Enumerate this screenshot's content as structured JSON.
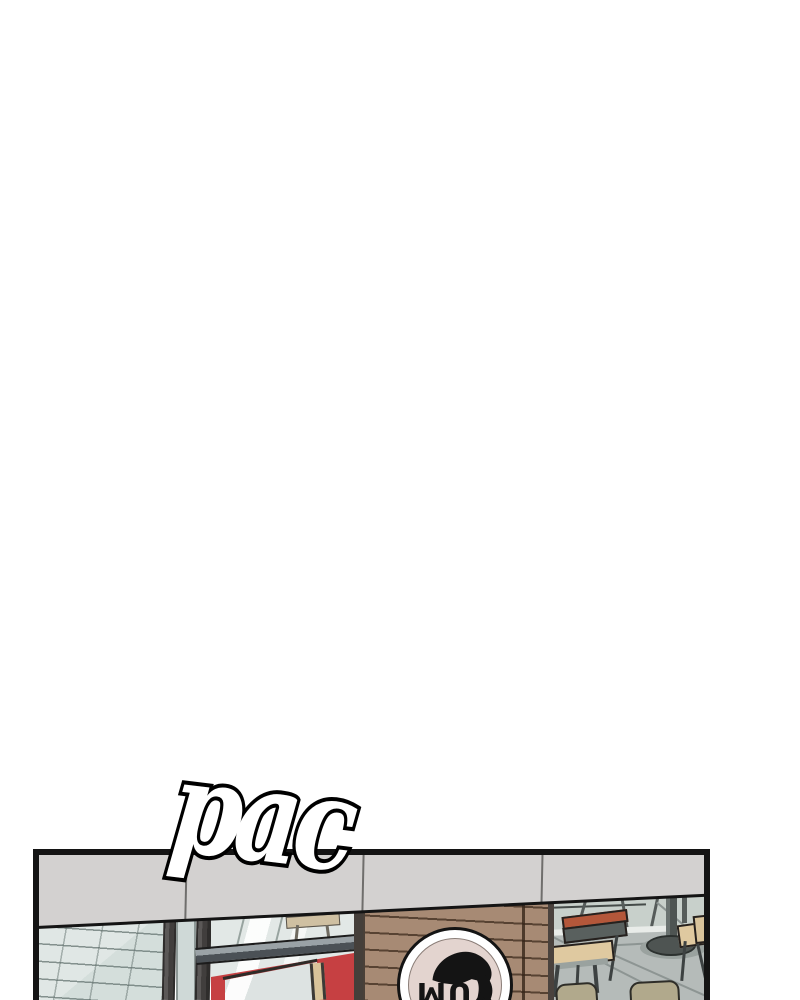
{
  "sfx": {
    "text": "pac"
  },
  "panel": {
    "logo_text": "YUM"
  },
  "colors": {
    "ink": "#141414",
    "paper": "#ffffff",
    "fascia": "#d3d1d0",
    "fascia-seam": "#6f6e6c",
    "glass": "#e0e7e5",
    "glass-mid": "#cfd9d7",
    "mullion-dark": "#2f2d2c",
    "mullion-mid": "#5b5857",
    "ledge-top": "#9aa2a6",
    "ledge-front": "#4b5156",
    "door-red": "#c64042",
    "door-tan": "#d9c49a",
    "wood": "#a78a74",
    "wood-edge": "#453f3a",
    "logo-ring": "#ffffff",
    "logo-face": "#e3d4cf",
    "int-wall": "#c8d0cb",
    "int-floor": "#b5bbb9",
    "int-stripe": "#e9ece9",
    "frame-gray": "#565c5a",
    "chair-rail": "#b4573a",
    "seat-tan": "#dfc9a0",
    "seat-khaki": "#b1a98c",
    "table-dark": "#4e5452",
    "leg-dark": "#3d4242"
  }
}
